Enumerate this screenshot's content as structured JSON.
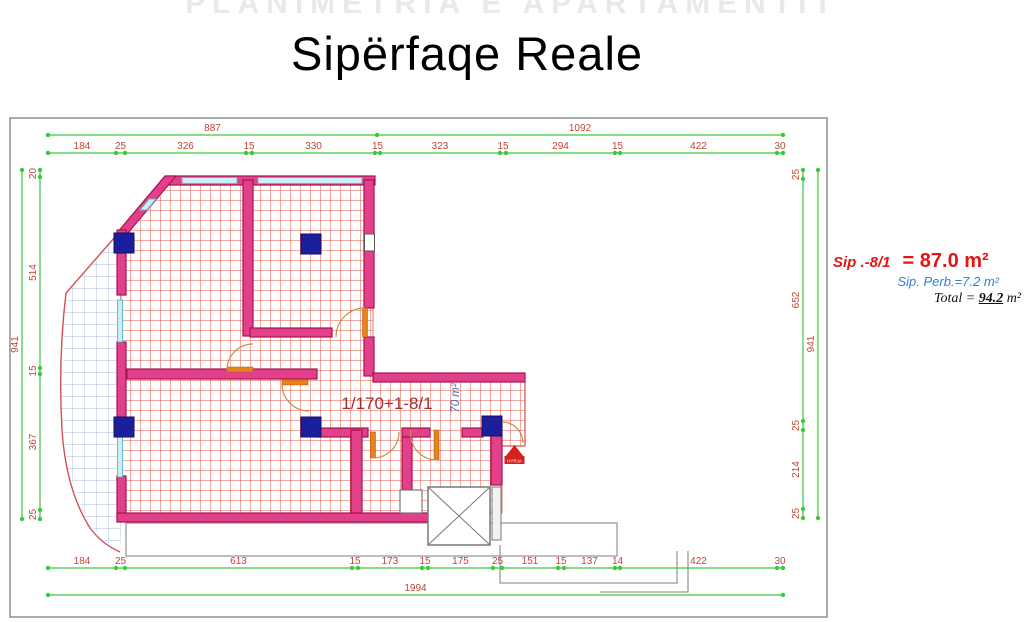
{
  "title": "Sipërfaqe Reale",
  "ghost_text": "PLANIMETRIA E APARTAMENTIT",
  "annotation": {
    "line1_label": "Sip .-8/1",
    "line1_value": "= 87.0 m²",
    "line2": "Sip. Perb.=7.2 m²",
    "line3_label": "Total",
    "line3_eq": "=",
    "line3_value": "94.2",
    "line3_unit": "m²"
  },
  "plan": {
    "room_label": "1/170+1-8/1",
    "area_rotated_label": "70 m²",
    "stamp_text": "HYRJA"
  },
  "dimensions": {
    "top_overall": [
      "887",
      "1092"
    ],
    "top_segments": [
      "184",
      "25",
      "326",
      "15",
      "330",
      "15",
      "323",
      "15",
      "294",
      "15",
      "422",
      "30"
    ],
    "left_overall": [
      "941"
    ],
    "left_segments": [
      "20",
      "514",
      "15",
      "367",
      "25"
    ],
    "right_segments": [
      "25",
      "652",
      "25",
      "214",
      "25"
    ],
    "right_overall": [
      "941"
    ],
    "bottom_segments": [
      "184",
      "25",
      "613",
      "15",
      "173",
      "15",
      "175",
      "25",
      "151",
      "15",
      "137",
      "14",
      "422",
      "30"
    ],
    "bottom_overall": [
      "1994"
    ]
  },
  "colors": {
    "dim_line_green": "#3bc93b",
    "dim_label_red": "#bf4536",
    "wall_magenta": "#e2408a",
    "wall_edge": "#a8134f",
    "hatch_red": "#e25648",
    "balcony_grid_blue": "#a9bedf",
    "column_navy": "#1b1f9e",
    "window_cyan": "#cdeef4",
    "door_orange": "#e8821e",
    "annotation_red": "#e31616",
    "annotation_blue": "#2c7fd8",
    "stamp_red": "#d62020"
  }
}
